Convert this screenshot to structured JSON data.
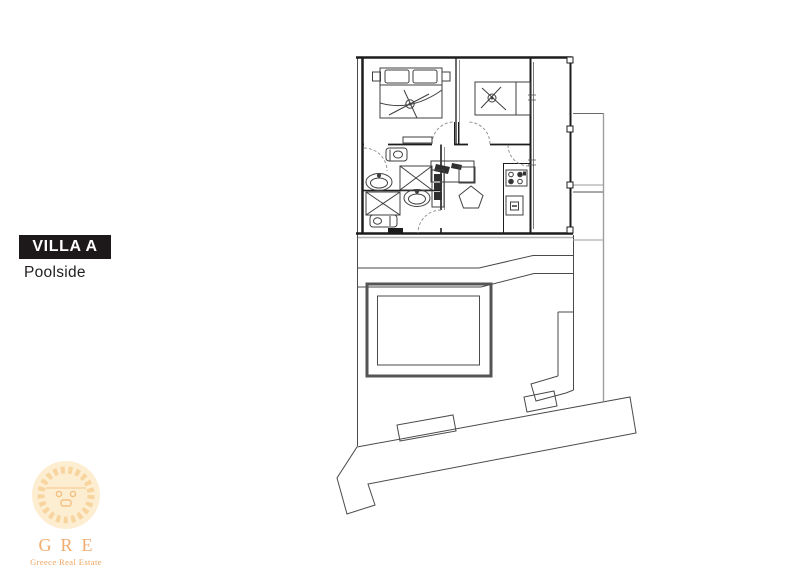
{
  "label": {
    "title": "VILLA A",
    "subtitle": "Poolside",
    "box_color": "#1d191a",
    "title_color": "#ffffff",
    "subtitle_color": "#242021"
  },
  "floor_plan": {
    "line_color": "#4a4a4a",
    "wall_color": "#1d1d1d",
    "boundary_color": "#9e9e9e",
    "door_arc_color": "#8a8a8a",
    "depicted_elements": [
      "bedroom-1",
      "bedroom-2",
      "bathroom-1",
      "bathroom-2",
      "living-kitchen",
      "deck",
      "side-terrace",
      "pool",
      "garden-walkway",
      "driveway",
      "site-boundary"
    ]
  },
  "logo": {
    "monogram": "GRE",
    "tagline": "Greece Real Estate",
    "monogram_color": "#f1a766",
    "tagline_color": "#ee9d53",
    "sun_fill": "#fdeac8",
    "sun_ray_color": "#f6c47c"
  }
}
